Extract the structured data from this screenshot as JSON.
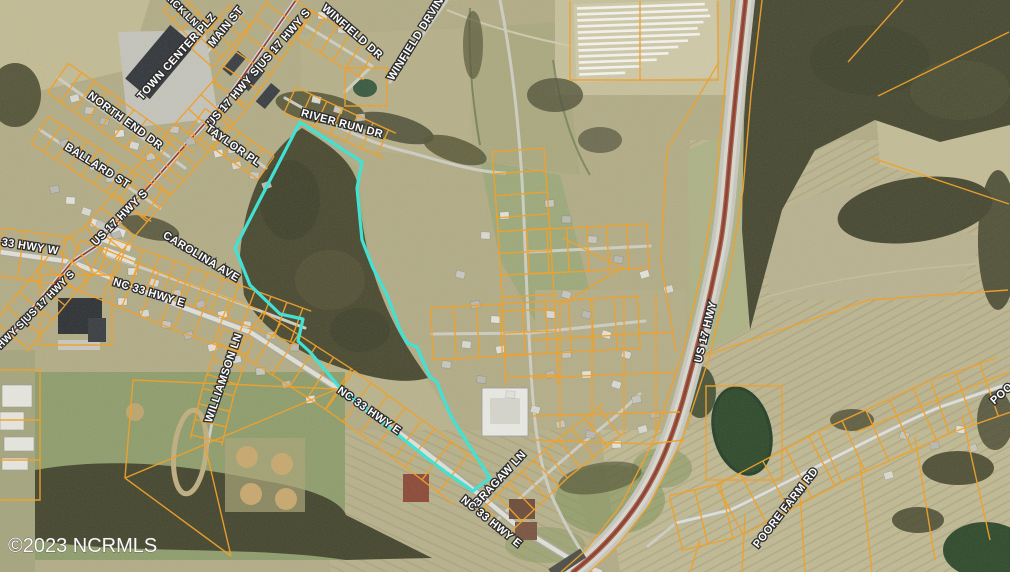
{
  "map": {
    "watermark": "©2023 NCRMLS",
    "colors": {
      "parcel_line": "#f2a024",
      "highlight_parcel": "#3ae4d5",
      "label_fill": "#ffffff",
      "label_halo": "#2d2d2d",
      "highway_median": "#8d3b2b"
    },
    "labels": [
      {
        "text": "RICK LN"
      },
      {
        "text": "TOWN CENTER PLZ"
      },
      {
        "text": "MAIN ST"
      },
      {
        "text": "US 17 HWY S|US 17 HWY S"
      },
      {
        "text": "WINFIELD DR"
      },
      {
        "text": "WINFIELD DRVIN"
      },
      {
        "text": "RIVER RUN DR"
      },
      {
        "text": "NORTH END DR"
      },
      {
        "text": "BALLARD ST"
      },
      {
        "text": "TAYLOR PL"
      },
      {
        "text": "US 17 HWY S"
      },
      {
        "text": "33 HWY W"
      },
      {
        "text": "CAROLINA AVE"
      },
      {
        "text": "NC 33 HWY E"
      },
      {
        "text": "HWY S|US 17 HWY S"
      },
      {
        "text": "WILLIAMSON LN"
      },
      {
        "text": "NC 33 HWY E"
      },
      {
        "text": "BRAGAW LN"
      },
      {
        "text": "NC 33 HWY E"
      },
      {
        "text": "US 17 HWY"
      },
      {
        "text": "POORE FARM RD"
      },
      {
        "text": "POO"
      }
    ]
  }
}
